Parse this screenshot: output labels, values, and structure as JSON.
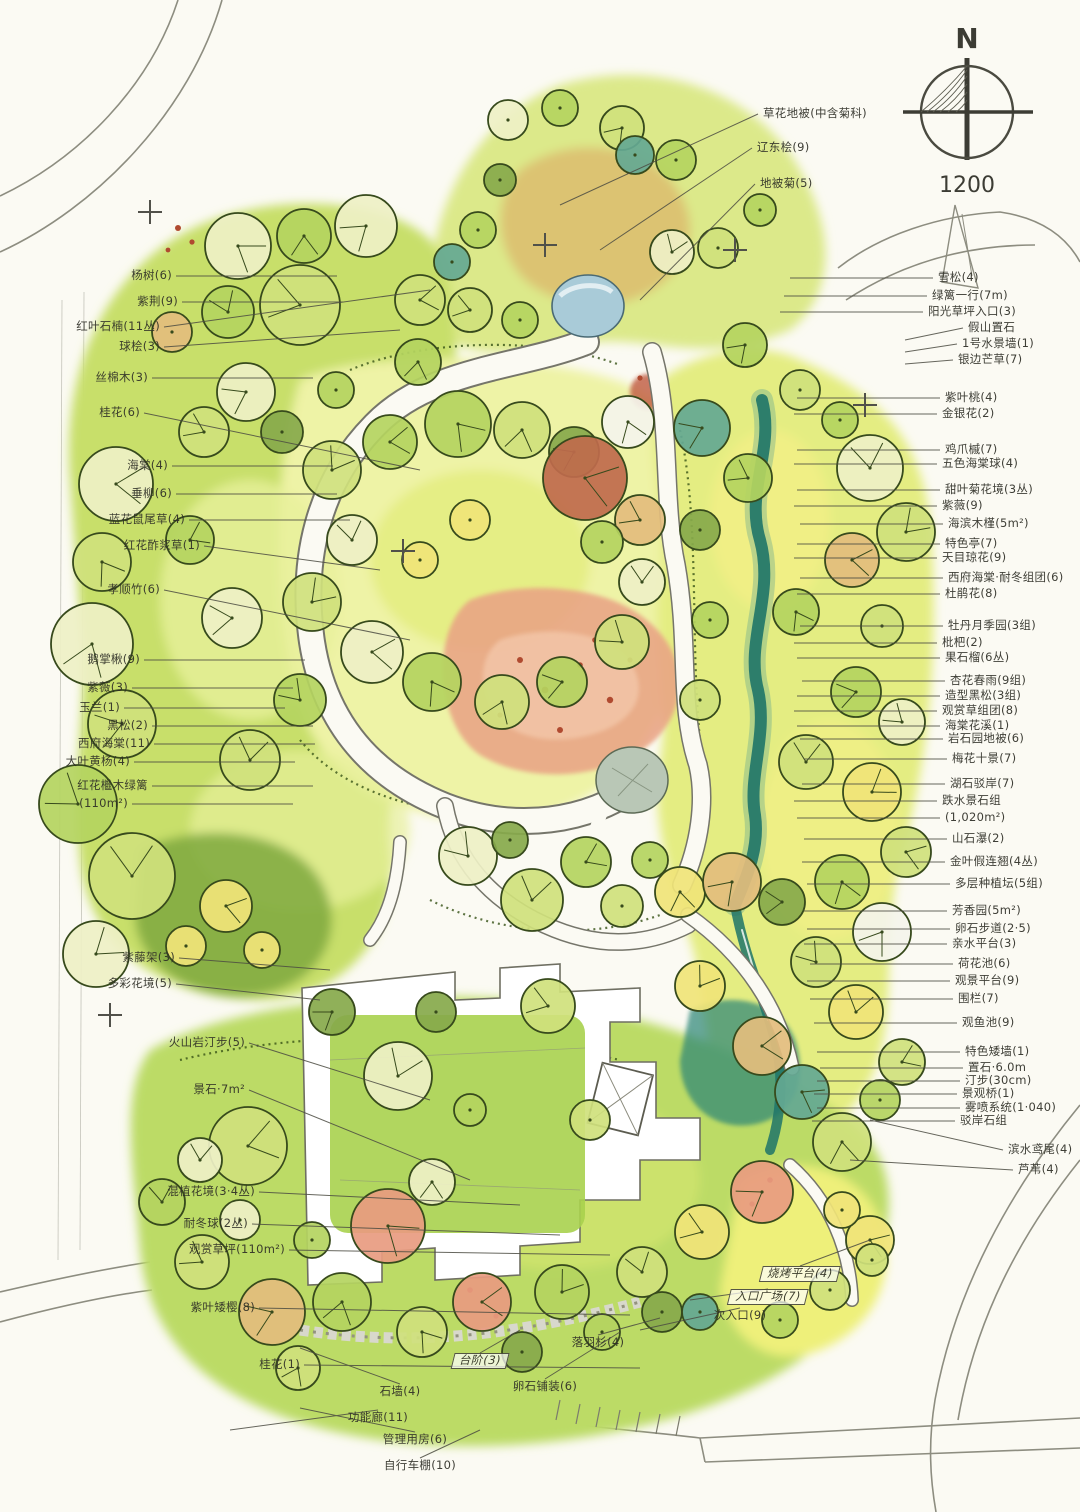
{
  "compass": {
    "north": "N",
    "scale": "1200"
  },
  "tree_palette": [
    "#cfe17c",
    "#b4d45f",
    "#eef0c6",
    "#e3bd7d",
    "#bf6a4c",
    "#64a893",
    "#f0e478",
    "#f4f4ec",
    "#87a94b",
    "#e89b80"
  ],
  "trees": [
    [
      238,
      246,
      33,
      2
    ],
    [
      304,
      236,
      27,
      1
    ],
    [
      366,
      226,
      31,
      2
    ],
    [
      300,
      305,
      40,
      0
    ],
    [
      228,
      312,
      26,
      1
    ],
    [
      172,
      332,
      20,
      3
    ],
    [
      420,
      300,
      25,
      0
    ],
    [
      452,
      262,
      18,
      5
    ],
    [
      418,
      362,
      23,
      1
    ],
    [
      246,
      392,
      29,
      2
    ],
    [
      204,
      432,
      25,
      0
    ],
    [
      282,
      432,
      21,
      8
    ],
    [
      336,
      390,
      18,
      1
    ],
    [
      116,
      484,
      37,
      2
    ],
    [
      102,
      562,
      29,
      0
    ],
    [
      92,
      644,
      41,
      2
    ],
    [
      122,
      724,
      34,
      0
    ],
    [
      78,
      804,
      39,
      1
    ],
    [
      132,
      876,
      43,
      0
    ],
    [
      96,
      954,
      33,
      2
    ],
    [
      226,
      906,
      26,
      6
    ],
    [
      186,
      946,
      20,
      6
    ],
    [
      262,
      950,
      18,
      6
    ],
    [
      232,
      618,
      30,
      2
    ],
    [
      300,
      700,
      26,
      1
    ],
    [
      250,
      760,
      30,
      0
    ],
    [
      190,
      540,
      24,
      1
    ],
    [
      508,
      120,
      20,
      2
    ],
    [
      560,
      108,
      18,
      1
    ],
    [
      622,
      128,
      22,
      0
    ],
    [
      676,
      160,
      20,
      1
    ],
    [
      635,
      155,
      19,
      5
    ],
    [
      672,
      252,
      22,
      2
    ],
    [
      718,
      248,
      20,
      0
    ],
    [
      500,
      180,
      16,
      8
    ],
    [
      478,
      230,
      18,
      1
    ],
    [
      760,
      210,
      16,
      1
    ],
    [
      470,
      310,
      22,
      0
    ],
    [
      520,
      320,
      18,
      1
    ],
    [
      332,
      470,
      29,
      0
    ],
    [
      390,
      442,
      27,
      1
    ],
    [
      458,
      424,
      33,
      1
    ],
    [
      522,
      430,
      28,
      0
    ],
    [
      574,
      452,
      25,
      8
    ],
    [
      640,
      520,
      25,
      3
    ],
    [
      352,
      540,
      25,
      2
    ],
    [
      312,
      602,
      29,
      0
    ],
    [
      372,
      652,
      31,
      2
    ],
    [
      432,
      682,
      29,
      1
    ],
    [
      502,
      702,
      27,
      0
    ],
    [
      562,
      682,
      25,
      1
    ],
    [
      622,
      642,
      27,
      0
    ],
    [
      642,
      582,
      23,
      2
    ],
    [
      602,
      542,
      21,
      1
    ],
    [
      585,
      478,
      42,
      4
    ],
    [
      628,
      422,
      26,
      7
    ],
    [
      470,
      520,
      20,
      6
    ],
    [
      420,
      560,
      18,
      6
    ],
    [
      468,
      856,
      29,
      2
    ],
    [
      532,
      900,
      31,
      0
    ],
    [
      586,
      862,
      25,
      1
    ],
    [
      622,
      906,
      21,
      0
    ],
    [
      680,
      892,
      25,
      6
    ],
    [
      732,
      882,
      29,
      3
    ],
    [
      510,
      840,
      18,
      8
    ],
    [
      650,
      860,
      18,
      1
    ],
    [
      398,
      1076,
      34,
      2
    ],
    [
      248,
      1146,
      39,
      0
    ],
    [
      388,
      1226,
      37,
      9
    ],
    [
      432,
      1182,
      23,
      2
    ],
    [
      332,
      1012,
      23,
      8
    ],
    [
      548,
      1006,
      27,
      0
    ],
    [
      436,
      1012,
      20,
      8
    ],
    [
      700,
      986,
      25,
      6
    ],
    [
      762,
      1046,
      29,
      3
    ],
    [
      590,
      1120,
      20,
      0
    ],
    [
      470,
      1110,
      16,
      1
    ],
    [
      702,
      428,
      28,
      5
    ],
    [
      748,
      478,
      24,
      1
    ],
    [
      870,
      468,
      33,
      2
    ],
    [
      906,
      532,
      29,
      0
    ],
    [
      852,
      560,
      27,
      3
    ],
    [
      796,
      612,
      23,
      1
    ],
    [
      882,
      626,
      21,
      0
    ],
    [
      856,
      692,
      25,
      1
    ],
    [
      902,
      722,
      23,
      2
    ],
    [
      806,
      762,
      27,
      0
    ],
    [
      872,
      792,
      29,
      6
    ],
    [
      906,
      852,
      25,
      0
    ],
    [
      842,
      882,
      27,
      1
    ],
    [
      882,
      932,
      29,
      7
    ],
    [
      782,
      902,
      23,
      8
    ],
    [
      816,
      962,
      25,
      0
    ],
    [
      856,
      1012,
      27,
      6
    ],
    [
      902,
      1062,
      23,
      0
    ],
    [
      802,
      1092,
      27,
      5
    ],
    [
      842,
      1142,
      29,
      0
    ],
    [
      745,
      345,
      22,
      1
    ],
    [
      800,
      390,
      20,
      0
    ],
    [
      840,
      420,
      18,
      1
    ],
    [
      700,
      530,
      20,
      8
    ],
    [
      710,
      620,
      18,
      1
    ],
    [
      700,
      700,
      20,
      0
    ],
    [
      880,
      1100,
      20,
      1
    ],
    [
      762,
      1192,
      31,
      9
    ],
    [
      702,
      1232,
      27,
      6
    ],
    [
      642,
      1272,
      25,
      0
    ],
    [
      562,
      1292,
      27,
      1
    ],
    [
      482,
      1302,
      29,
      9
    ],
    [
      422,
      1332,
      25,
      0
    ],
    [
      342,
      1302,
      29,
      1
    ],
    [
      272,
      1312,
      33,
      3
    ],
    [
      202,
      1262,
      27,
      0
    ],
    [
      162,
      1202,
      23,
      1
    ],
    [
      522,
      1352,
      20,
      8
    ],
    [
      602,
      1332,
      18,
      1
    ],
    [
      662,
      1312,
      20,
      8
    ],
    [
      298,
      1368,
      22,
      0
    ],
    [
      240,
      1220,
      20,
      2
    ],
    [
      312,
      1240,
      18,
      1
    ],
    [
      200,
      1160,
      22,
      2
    ],
    [
      700,
      1312,
      18,
      5
    ],
    [
      870,
      1240,
      24,
      6
    ],
    [
      830,
      1290,
      20,
      0
    ],
    [
      780,
      1320,
      18,
      1
    ],
    [
      842,
      1210,
      18,
      6
    ],
    [
      872,
      1260,
      16,
      0
    ]
  ],
  "annotations": {
    "left": [
      {
        "t": "杨树(6)",
        "x": 172,
        "y": 276
      },
      {
        "t": "紫荆(9)",
        "x": 178,
        "y": 302
      },
      {
        "t": "红叶石楠(11丛)",
        "x": 160,
        "y": 327,
        "tx": 430,
        "ty": 290
      },
      {
        "t": "球桧(3)",
        "x": 160,
        "y": 347,
        "tx": 400,
        "ty": 330
      },
      {
        "t": "丝棉木(3)",
        "x": 148,
        "y": 378
      },
      {
        "t": "桂花(6)",
        "x": 140,
        "y": 413,
        "tx": 420,
        "ty": 470
      },
      {
        "t": "海棠(4)",
        "x": 168,
        "y": 466
      },
      {
        "t": "垂柳(6)",
        "x": 172,
        "y": 494
      },
      {
        "t": "蓝花鼠尾草(4)",
        "x": 185,
        "y": 520
      },
      {
        "t": "红花酢浆草(1)",
        "x": 200,
        "y": 546,
        "tx": 380,
        "ty": 570
      },
      {
        "t": "孝顺竹(6)",
        "x": 160,
        "y": 590,
        "tx": 410,
        "ty": 640
      },
      {
        "t": "鹅掌楸(9)",
        "x": 140,
        "y": 660
      },
      {
        "t": "紫薇(3)",
        "x": 128,
        "y": 688
      },
      {
        "t": "玉兰(1)",
        "x": 120,
        "y": 708
      },
      {
        "t": "黑松(2)",
        "x": 148,
        "y": 726
      },
      {
        "t": "西府海棠(11)",
        "x": 150,
        "y": 744
      },
      {
        "t": "大叶黄杨(4)",
        "x": 130,
        "y": 762
      },
      {
        "t": "红花檵木绿篱",
        "x": 148,
        "y": 786
      },
      {
        "t": "(110m²)",
        "x": 128,
        "y": 804
      },
      {
        "t": "紫藤架(3)",
        "x": 175,
        "y": 958,
        "tx": 330,
        "ty": 970
      },
      {
        "t": "多彩花境(5)",
        "x": 172,
        "y": 984,
        "tx": 320,
        "ty": 1000
      },
      {
        "t": "火山岩汀步(5)",
        "x": 245,
        "y": 1043,
        "tx": 430,
        "ty": 1100
      },
      {
        "t": "景石·7m²",
        "x": 245,
        "y": 1090,
        "tx": 470,
        "ty": 1180
      },
      {
        "t": "混植花境(3·4丛)",
        "x": 255,
        "y": 1192,
        "tx": 520,
        "ty": 1205
      },
      {
        "t": "耐冬球(2丛)",
        "x": 248,
        "y": 1224,
        "tx": 560,
        "ty": 1235
      },
      {
        "t": "观赏草坪(110m²)",
        "x": 285,
        "y": 1250,
        "tx": 610,
        "ty": 1255
      },
      {
        "t": "紫叶矮樱(8)",
        "x": 255,
        "y": 1308,
        "tx": 630,
        "ty": 1315
      },
      {
        "t": "桂花(1)",
        "x": 300,
        "y": 1365,
        "tx": 640,
        "ty": 1368
      }
    ],
    "top": [
      {
        "t": "草花地被(中含菊科)",
        "x": 763,
        "y": 114,
        "tx": 560,
        "ty": 205
      },
      {
        "t": "辽东桧(9)",
        "x": 757,
        "y": 148,
        "tx": 600,
        "ty": 250
      },
      {
        "t": "地被菊(5)",
        "x": 760,
        "y": 184,
        "tx": 640,
        "ty": 300
      }
    ],
    "right": [
      {
        "t": "雪松(4)",
        "x": 938,
        "y": 278
      },
      {
        "t": "绿篱一行(7m)",
        "x": 932,
        "y": 296
      },
      {
        "t": "阳光草坪入口(3)",
        "x": 928,
        "y": 312
      },
      {
        "t": "假山置石",
        "x": 968,
        "y": 328,
        "tx": 905,
        "ty": 340
      },
      {
        "t": "1号水景墙(1)",
        "x": 962,
        "y": 344,
        "tx": 905,
        "ty": 352
      },
      {
        "t": "银边芒草(7)",
        "x": 958,
        "y": 360,
        "tx": 905,
        "ty": 364
      },
      {
        "t": "紫叶桃(4)",
        "x": 945,
        "y": 398
      },
      {
        "t": "金银花(2)",
        "x": 942,
        "y": 414
      },
      {
        "t": "鸡爪槭(7)",
        "x": 945,
        "y": 450
      },
      {
        "t": "五色海棠球(4)",
        "x": 942,
        "y": 464
      },
      {
        "t": "甜叶菊花境(3丛)",
        "x": 945,
        "y": 490
      },
      {
        "t": "紫薇(9)",
        "x": 942,
        "y": 506
      },
      {
        "t": "海滨木槿(5m²)",
        "x": 948,
        "y": 524
      },
      {
        "t": "特色亭(7)",
        "x": 945,
        "y": 544
      },
      {
        "t": "天目琼花(9)",
        "x": 942,
        "y": 558
      },
      {
        "t": "西府海棠·耐冬组团(6)",
        "x": 948,
        "y": 578
      },
      {
        "t": "杜鹃花(8)",
        "x": 945,
        "y": 594
      },
      {
        "t": "牡丹月季园(3组)",
        "x": 948,
        "y": 626
      },
      {
        "t": "枇杷(2)",
        "x": 942,
        "y": 643
      },
      {
        "t": "果石榴(6丛)",
        "x": 945,
        "y": 658
      },
      {
        "t": "杏花春雨(9组)",
        "x": 950,
        "y": 681
      },
      {
        "t": "造型黑松(3组)",
        "x": 945,
        "y": 696
      },
      {
        "t": "观赏草组团(8)",
        "x": 942,
        "y": 711
      },
      {
        "t": "海棠花溪(1)",
        "x": 945,
        "y": 726
      },
      {
        "t": "岩石园地被(6)",
        "x": 948,
        "y": 739
      },
      {
        "t": "梅花十景(7)",
        "x": 952,
        "y": 759
      },
      {
        "t": "湖石驳岸(7)",
        "x": 950,
        "y": 784
      },
      {
        "t": "跌水景石组",
        "x": 942,
        "y": 801
      },
      {
        "t": "(1,020m²)",
        "x": 945,
        "y": 818
      },
      {
        "t": "山石瀑(2)",
        "x": 952,
        "y": 839
      },
      {
        "t": "金叶假连翘(4丛)",
        "x": 950,
        "y": 862
      },
      {
        "t": "多层种植坛(5组)",
        "x": 955,
        "y": 884
      },
      {
        "t": "芳香园(5m²)",
        "x": 952,
        "y": 911
      },
      {
        "t": "卵石步道(2·5)",
        "x": 955,
        "y": 929
      },
      {
        "t": "亲水平台(3)",
        "x": 952,
        "y": 944
      },
      {
        "t": "荷花池(6)",
        "x": 958,
        "y": 964
      },
      {
        "t": "观景平台(9)",
        "x": 955,
        "y": 981
      },
      {
        "t": "围栏(7)",
        "x": 958,
        "y": 999
      },
      {
        "t": "观鱼池(9)",
        "x": 962,
        "y": 1023
      },
      {
        "t": "特色矮墙(1)",
        "x": 965,
        "y": 1052
      },
      {
        "t": "置石·6.0m",
        "x": 968,
        "y": 1068
      },
      {
        "t": "汀步(30cm)",
        "x": 965,
        "y": 1081
      },
      {
        "t": "景观桥(1)",
        "x": 962,
        "y": 1094
      },
      {
        "t": "雾喷系统(1·040)",
        "x": 965,
        "y": 1108
      },
      {
        "t": "驳岸石组",
        "x": 960,
        "y": 1121
      },
      {
        "t": "滨水鸢尾(4)",
        "x": 1008,
        "y": 1150,
        "tx": 870,
        "ty": 1120
      },
      {
        "t": "芦苇(4)",
        "x": 1018,
        "y": 1170,
        "tx": 850,
        "ty": 1160
      }
    ],
    "bottom": [
      {
        "t": "落羽杉(4)",
        "x": 598,
        "y": 1343,
        "tx": 660,
        "ty": 1318
      },
      {
        "t": "卵石铺装(6)",
        "x": 545,
        "y": 1387,
        "tx": 620,
        "ty": 1332
      },
      {
        "t": "石墙(4)",
        "x": 400,
        "y": 1392,
        "tx": 300,
        "ty": 1348
      },
      {
        "t": "功能廊(11)",
        "x": 378,
        "y": 1418,
        "tx": 230,
        "ty": 1430
      },
      {
        "t": "管理用房(6)",
        "x": 415,
        "y": 1440,
        "tx": 300,
        "ty": 1408
      },
      {
        "t": "自行车棚(10)",
        "x": 420,
        "y": 1466,
        "tx": 480,
        "ty": 1430
      },
      {
        "t": "次入口(9)",
        "x": 740,
        "y": 1316,
        "tx": 640,
        "ty": 1330
      }
    ],
    "boxed": [
      {
        "t": "烧烤平台(4)",
        "x": 800,
        "y": 1274,
        "tx": 870,
        "ty": 1240
      },
      {
        "t": "入口广场(7)",
        "x": 768,
        "y": 1297,
        "tx": 690,
        "ty": 1300
      },
      {
        "t": "台阶(3)",
        "x": 480,
        "y": 1361,
        "tx": 520,
        "ty": 1330
      }
    ]
  }
}
